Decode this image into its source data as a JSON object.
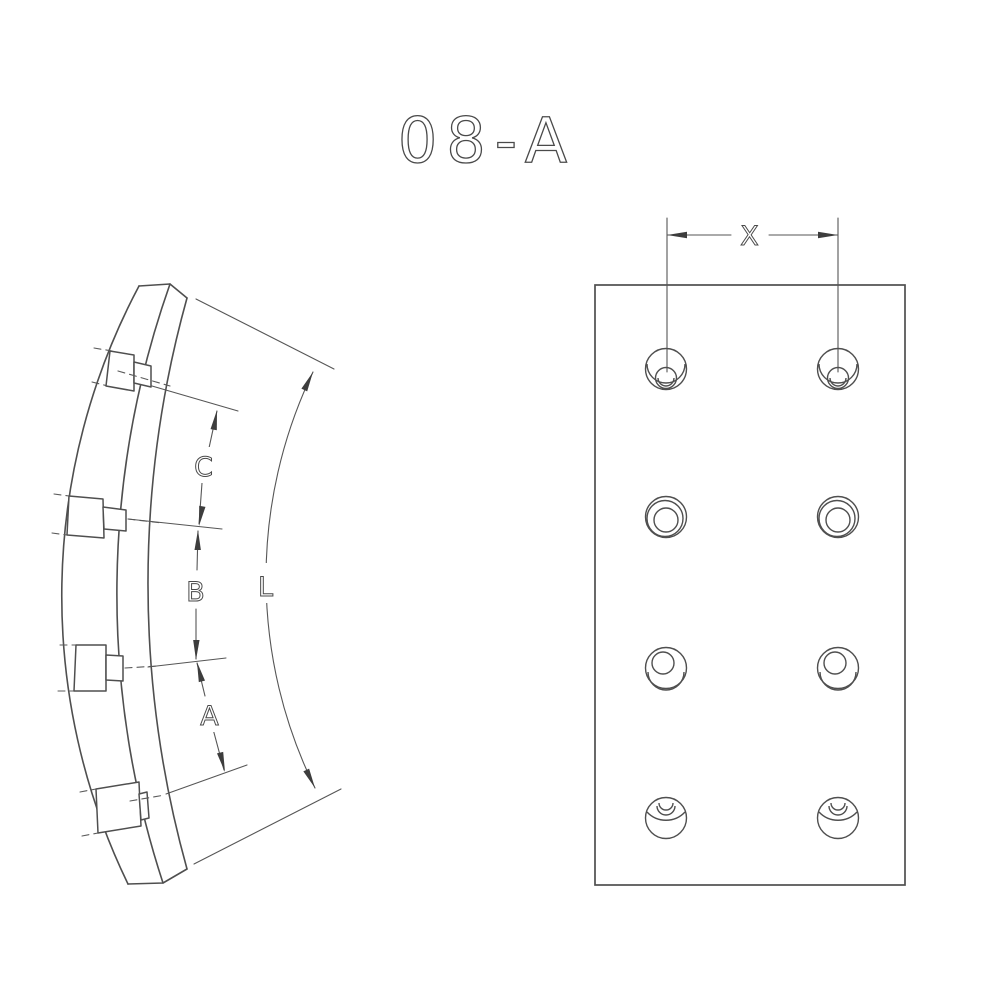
{
  "title": "08-A",
  "colors": {
    "line_color": "#4f4f4f",
    "background": "#ffffff"
  },
  "side_view": {
    "description": "curved brake lining segment side view with 4 rivet bolts",
    "rivet_count": 4,
    "dimensions": {
      "c_label": "C",
      "b_label": "B",
      "a_label": "A",
      "arc_length_label": "L"
    }
  },
  "face_view": {
    "description": "flat face view of lining with rivet holes",
    "hole_rows": 4,
    "hole_columns": 2,
    "dimensions": {
      "hole_spacing_label": "X"
    }
  }
}
